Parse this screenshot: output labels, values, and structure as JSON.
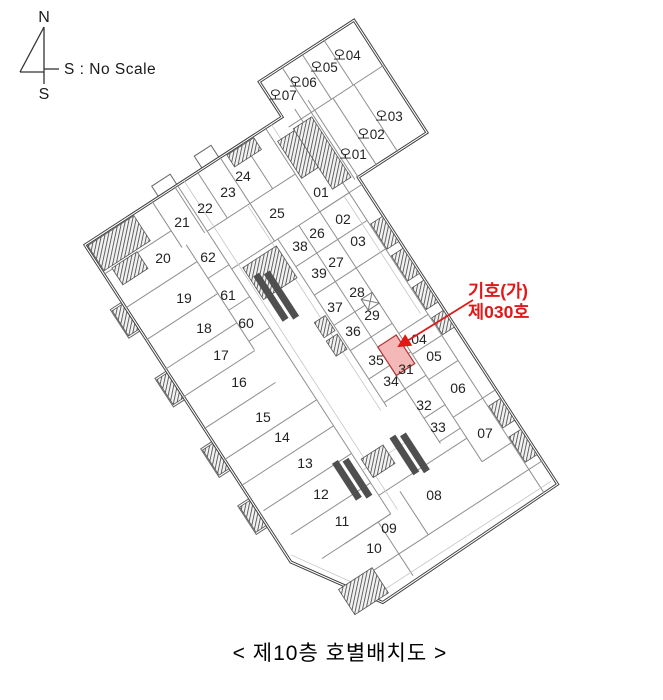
{
  "compass": {
    "north": "N",
    "south": "S",
    "scale_note": "S : No Scale"
  },
  "annotation": {
    "line1": "기호(가)",
    "line2": "제030호"
  },
  "caption": "< 제10층 호별배치도 >",
  "colors": {
    "annotation_red": "#e01818",
    "highlight_fill": "#f5b8b8",
    "highlight_border": "#b03636",
    "outline": "#3d3d3d",
    "wall": "#8f8f8f"
  },
  "highlighted_unit": {
    "label": "030",
    "description_lines": [
      "기호(가)",
      "제030호"
    ]
  },
  "rooms": [
    {
      "id": "오04",
      "x": 347,
      "y": 55,
      "wing": true
    },
    {
      "id": "오05",
      "x": 324,
      "y": 67,
      "wing": true
    },
    {
      "id": "오06",
      "x": 303,
      "y": 82,
      "wing": true
    },
    {
      "id": "오07",
      "x": 283,
      "y": 95,
      "wing": true
    },
    {
      "id": "오03",
      "x": 389,
      "y": 116,
      "wing": true
    },
    {
      "id": "오02",
      "x": 371,
      "y": 134,
      "wing": true
    },
    {
      "id": "오01",
      "x": 353,
      "y": 154,
      "wing": true
    },
    {
      "id": "01",
      "x": 321,
      "y": 192
    },
    {
      "id": "02",
      "x": 343,
      "y": 219
    },
    {
      "id": "03",
      "x": 358,
      "y": 241
    },
    {
      "id": "04",
      "x": 419,
      "y": 339
    },
    {
      "id": "05",
      "x": 434,
      "y": 356
    },
    {
      "id": "06",
      "x": 458,
      "y": 388
    },
    {
      "id": "07",
      "x": 485,
      "y": 433
    },
    {
      "id": "08",
      "x": 434,
      "y": 495
    },
    {
      "id": "09",
      "x": 389,
      "y": 528
    },
    {
      "id": "10",
      "x": 374,
      "y": 548
    },
    {
      "id": "11",
      "x": 342,
      "y": 521
    },
    {
      "id": "12",
      "x": 321,
      "y": 494
    },
    {
      "id": "13",
      "x": 305,
      "y": 463
    },
    {
      "id": "14",
      "x": 282,
      "y": 437
    },
    {
      "id": "15",
      "x": 263,
      "y": 417
    },
    {
      "id": "16",
      "x": 239,
      "y": 382
    },
    {
      "id": "17",
      "x": 221,
      "y": 355
    },
    {
      "id": "18",
      "x": 204,
      "y": 328
    },
    {
      "id": "19",
      "x": 184,
      "y": 298
    },
    {
      "id": "20",
      "x": 163,
      "y": 258
    },
    {
      "id": "21",
      "x": 182,
      "y": 222
    },
    {
      "id": "22",
      "x": 205,
      "y": 208
    },
    {
      "id": "23",
      "x": 228,
      "y": 192
    },
    {
      "id": "24",
      "x": 243,
      "y": 176
    },
    {
      "id": "25",
      "x": 277,
      "y": 213
    },
    {
      "id": "26",
      "x": 317,
      "y": 233
    },
    {
      "id": "27",
      "x": 336,
      "y": 262
    },
    {
      "id": "28",
      "x": 357,
      "y": 292
    },
    {
      "id": "29",
      "x": 372,
      "y": 315
    },
    {
      "id": "31",
      "x": 406,
      "y": 369
    },
    {
      "id": "32",
      "x": 424,
      "y": 405
    },
    {
      "id": "33",
      "x": 438,
      "y": 427
    },
    {
      "id": "34",
      "x": 391,
      "y": 381
    },
    {
      "id": "35",
      "x": 376,
      "y": 360
    },
    {
      "id": "36",
      "x": 353,
      "y": 331
    },
    {
      "id": "37",
      "x": 335,
      "y": 307
    },
    {
      "id": "38",
      "x": 300,
      "y": 246
    },
    {
      "id": "39",
      "x": 319,
      "y": 273
    },
    {
      "id": "60",
      "x": 246,
      "y": 323
    },
    {
      "id": "61",
      "x": 228,
      "y": 295
    },
    {
      "id": "62",
      "x": 208,
      "y": 257
    }
  ]
}
